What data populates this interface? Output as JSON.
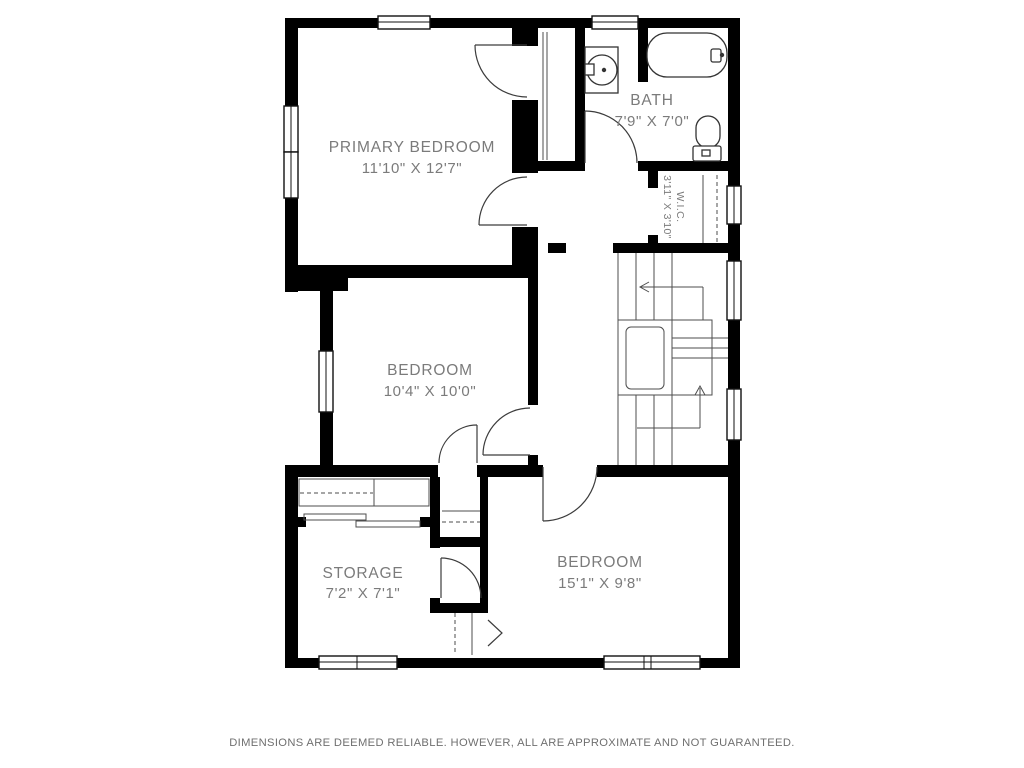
{
  "plan": {
    "rooms": [
      {
        "name": "PRIMARY BEDROOM",
        "dims": "11'10\" X 12'7\""
      },
      {
        "name": "BATH",
        "dims": "7'9\" X 7'0\""
      },
      {
        "name": "W.I.C.",
        "dims": "3'11\" X 3'10\""
      },
      {
        "name": "BEDROOM",
        "dims": "10'4\" X 10'0\""
      },
      {
        "name": "STORAGE",
        "dims": "7'2\" X 7'1\""
      },
      {
        "name": "BEDROOM",
        "dims": "15'1\" X 9'8\""
      }
    ]
  },
  "footer": {
    "disclaimer": "DIMENSIONS ARE DEEMED RELIABLE. HOWEVER, ALL ARE APPROXIMATE AND NOT GUARANTEED."
  }
}
